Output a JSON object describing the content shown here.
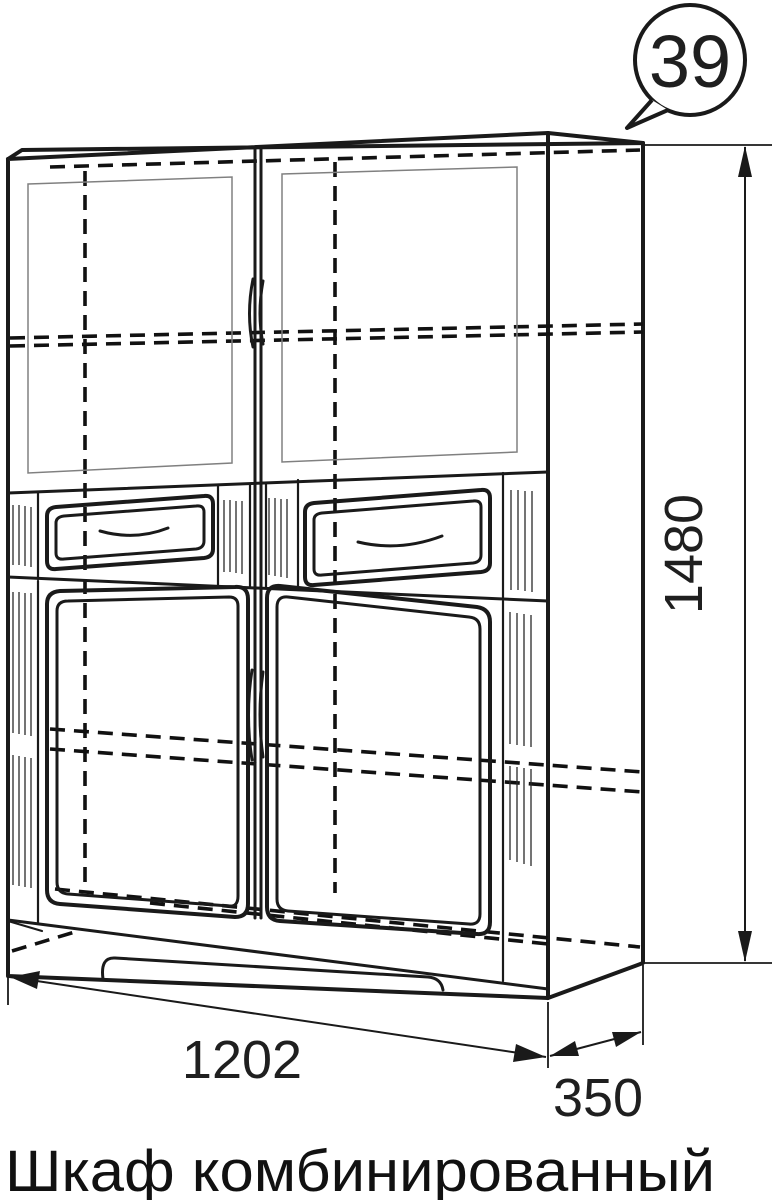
{
  "callout": {
    "number": "39"
  },
  "dimensions": {
    "height_mm": "1480",
    "width_mm": "1202",
    "depth_mm": "350"
  },
  "caption": {
    "title": "Шкаф комбинированный"
  },
  "colors": {
    "line": "#1a1a1a",
    "thin_line": "#808080",
    "background": "#ffffff"
  }
}
